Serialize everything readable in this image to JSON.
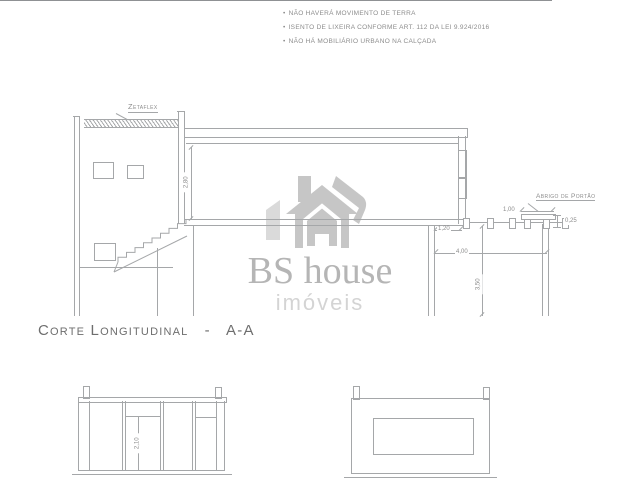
{
  "colors": {
    "line": "#a5a7a9",
    "text": "#8c8c8c",
    "watermark_house_dark": "#c6c6c6",
    "watermark_house_light": "#dadada",
    "watermark_brand": "#b5b5b5",
    "watermark_tagline": "#d4d4d4"
  },
  "notes": {
    "bullet": "•",
    "clipped_line": "5.296/04 E NBR 9.050/20",
    "items": [
      "NÃO HAVERÁ MOVIMENTO DE TERRA",
      "ISENTO DE LIXEIRA CONFORME ART. 112 DA LEI 9.924/2016",
      "NÃO HÁ MOBILIÁRIO URBANO NA CALÇADA"
    ]
  },
  "section_drawing": {
    "labels": {
      "roof_material": "Zetaflex",
      "gate_shelter": "Abrigo de Portão"
    },
    "dimensions": {
      "upper_ceiling_height": "2,80",
      "slab_overhang": "1,20",
      "gate_shelter_width": "1,00",
      "gate_shelter_height": "0,25",
      "front_yard_width": "4,00",
      "ground_floor_height": "3,50"
    }
  },
  "title": "Corte Longitudinal   -   A-A",
  "watermark": {
    "brand": "BS house",
    "tagline": "imóveis"
  },
  "elevations": {
    "door_height": "2,10"
  }
}
